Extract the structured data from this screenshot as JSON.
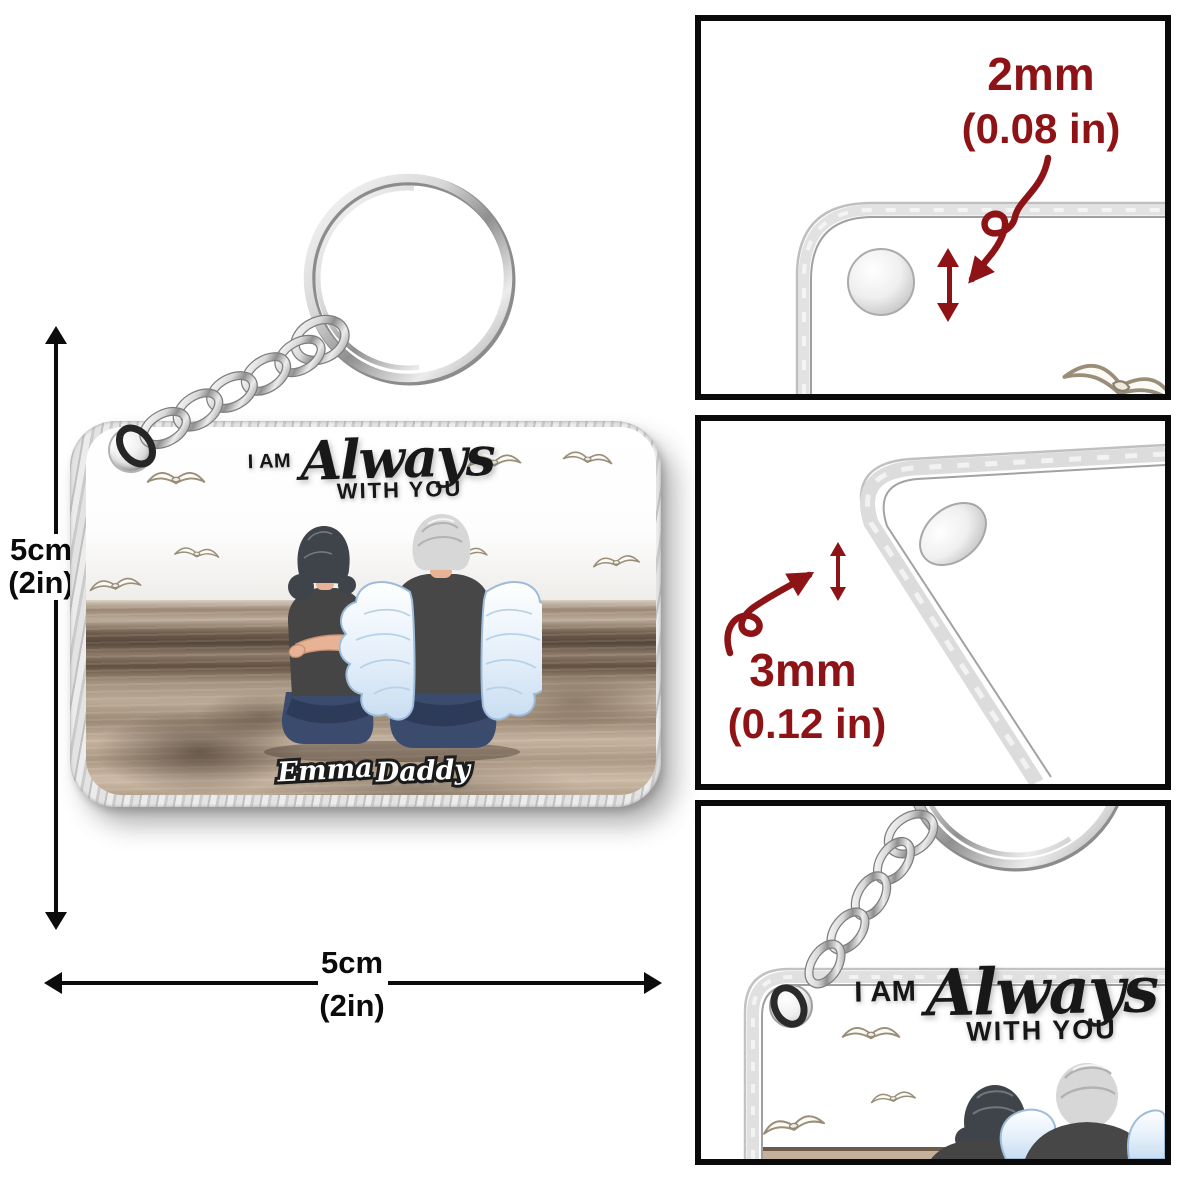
{
  "product": {
    "title": {
      "prefix": "I AM",
      "script": "Always",
      "suffix": "WITH YOU"
    },
    "names": [
      {
        "label": "Emma"
      },
      {
        "label": "Daddy"
      }
    ]
  },
  "dimensions": {
    "height": {
      "value": "5cm",
      "alt": "(2in)"
    },
    "width": {
      "value": "5cm",
      "alt": "(2in)"
    }
  },
  "callouts": {
    "hole": {
      "value": "2mm",
      "alt": "(0.08 in)"
    },
    "thickness": {
      "value": "3mm",
      "alt": "(0.12 in)"
    }
  },
  "colors": {
    "annotation_red": "#8e1316",
    "dimension_black": "#0c0c0c",
    "wing_blue": "#dcebfa",
    "shirt_gray": "#474747",
    "jeans_blue": "#3b4b6d",
    "hair_dark": "#3f444b",
    "hair_silver": "#d7d7d7",
    "skin": "#e7b295",
    "sand_brown": "#9c8a76"
  }
}
